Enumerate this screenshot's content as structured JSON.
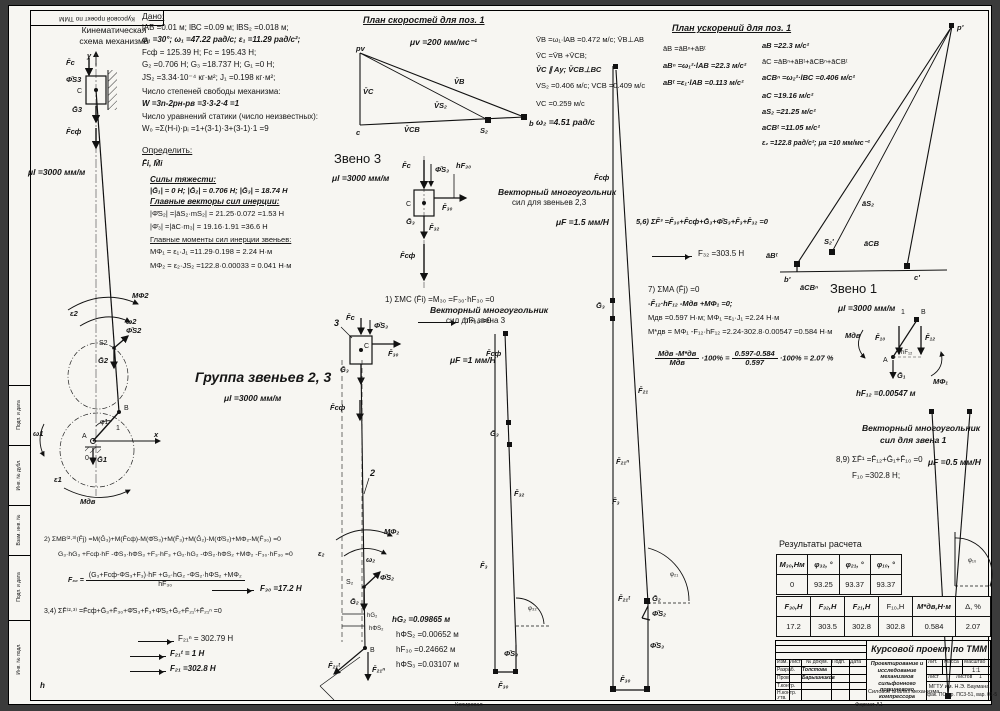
{
  "frame": {
    "top_stamp": "Курсовой проект по ТММ",
    "margin_labels": [
      "Подп. и дата",
      "Инв. № дубл.",
      "Взам. инв. №",
      "Подп. и дата",
      "Инв. № подл."
    ],
    "kopiroval": "Копировал",
    "format": "Формат А1",
    "stray_h": "h"
  },
  "kin": {
    "title1": "Кинематическая",
    "title2": "схема механизма",
    "scale": "μl =3000 мм/м",
    "labels": {
      "y": "y",
      "x": "x",
      "Fc": "F̄с",
      "PhiS3": "Φ̄S3",
      "C": "C",
      "G3": "Ḡ3",
      "Fsf": "F̄сф",
      "MPhi2": "MΦ2",
      "eps2": "ε2",
      "omega2": "ω2",
      "S2": "S2",
      "PhiS2": "Φ̄S2",
      "G2": "Ḡ2",
      "B": "B",
      "phi1": "φ1",
      "one": "1",
      "A": "A",
      "zero": "0",
      "G1": "Ḡ1",
      "omega1": "ω1",
      "eps1": "ε1",
      "Mdv": "Mдв"
    }
  },
  "given": {
    "title": "Дано:",
    "lines": [
      "lАВ =0.01 м; lВС =0.09 м; lBS₂ =0.018 м;",
      "φ₁ =30°; ω₁ =47.22 рад/с; ε₁ =11.29 рад/с²;",
      "Fсф = 125.39 Н; Fс = 195.43 Н;",
      "G₂ =0.706 Н; G₃ =18.737 Н; G₁ =0 Н;",
      "JS₂ =3.34·10⁻⁴ кг·м²; J₁ =0.198 кг·м²;",
      "Число степеней свободы механизма:",
      "W =3n-2pн-pв =3·3-2·4 =1",
      "Число уравнений статики (число неизвестных):",
      "W₀ =Σ(H-i)·pᵢ =1+(3-1)·3+(3-1)·1 =9"
    ]
  },
  "opr": {
    "title": "Определить:",
    "value": "F̄i, M̄i"
  },
  "forces": {
    "lines": [
      "Силы тяжести:",
      "|Ḡ₁| = 0 Н; |Ḡ₂| = 0.706 Н; |Ḡ₃| = 18.74 Н",
      "Главные векторы сил инерции:",
      "|Φ̄S₂| =|āS₂·mS₂| = 21.25·0.072 =1.53 Н",
      "|Φ̄₃| =|āC·m₃| = 19.16·1.91 =36.6 Н",
      "Главные моменты сил инерции звеньев:",
      "MΦ₁ = ε₁·J₁ =11.29·0.198 = 2.24 Н·м",
      "MΦ₂ = ε₂·JS₂ =122.8·0.00033 = 0.041 Н·м"
    ]
  },
  "vplan": {
    "title": "План скоростей для поз. 1",
    "scale": "μv =200 мм/мс⁻¹",
    "formulas": [
      "V̄B =ω₁·lАВ =0.472 м/с;  V̄B⊥АВ",
      "V̄C =V̄B +V̄CB;",
      "V̄C ∥ Ay;  V̄CB⊥ВС",
      "VS₂ =0.406 м/с;   VСВ =0.409 м/с",
      "VC =0.259 м/с",
      "ω₂ =4.51 рад/с"
    ],
    "labels": {
      "pv": "pv",
      "c": "c",
      "b": "b",
      "S2": "S₂",
      "VC": "V̄C",
      "VB": "V̄B",
      "VS2": "V̄S₂",
      "VCB": "V̄CB"
    }
  },
  "aplan": {
    "title": "План ускорений для поз. 1",
    "col1": [
      "āB =āBⁿ+āBᵗ",
      "aBⁿ =ω₁²·lАВ =22.3 м/с²",
      "aBᵗ =ε₁·lАВ =0.113 м/с²"
    ],
    "col2": [
      "aB =22.3 м/с²",
      "āC =āBⁿ+āBᵗ+āCBⁿ+āCBᵗ",
      "aCBⁿ =ω₂²·lВС =0.406 м/с²",
      "aC =19.16 м/с²",
      "aS₂ =21.25 м/с²",
      "aCBᵗ =11.05 м/с²",
      "ε₂ =122.8 рад/с²;  μa =10 мм/мс⁻²"
    ],
    "labels": {
      "p": "p'",
      "aS2": "āS₂",
      "aCB": "āCB",
      "aBt": "āBᵗ",
      "S2": "S₂'",
      "b": "b'",
      "aCBn": "āCBⁿ",
      "c": "c'"
    }
  },
  "zv3": {
    "title": "Звено 3",
    "scale": "μl =3000 мм/м",
    "eq": "1) ΣMC (F̄i) =M₃₀ =F₃₀·hF₃₀ =0",
    "res": "hF₃₀ =0",
    "labels": {
      "Fc": "F̄с",
      "PhiS3": "Φ̄S₃",
      "hF30": "hF₃₀",
      "F30": "F̄₃₀",
      "C": "C",
      "G3": "Ḡ₃",
      "F32": "F̄₃₂",
      "Fsf": "F̄сф"
    }
  },
  "poly23": {
    "t1": "Векторный многоугольник",
    "t2": "сил для звеньев 2,3",
    "scale": "μF =1.5 мм/Н",
    "labels": {
      "Fsf": "F̄сф",
      "G3": "Ḡ₃",
      "F21": "F̄₂₁",
      "F21n": "F̄₂₁ⁿ",
      "F3": "F̄₃",
      "F21t": "F̄₂₁ᵗ",
      "G2": "Ḡ₂",
      "PhiS2": "Φ̄S₂",
      "phi21": "φ₂₁",
      "PhiS3": "Φ̄S₃",
      "F30": "F̄₃₀"
    }
  },
  "poly3": {
    "t1": "Векторный многоугольник",
    "t2": "сил для звена 3",
    "scale": "μF =1 мм/Н",
    "labels": {
      "Fsf": "F̄сф",
      "G3": "Ḡ₃",
      "F32": "F̄₃₂",
      "F3": "F̄₃",
      "phi32": "φ₃₂",
      "PhiS3": "Φ̄S₃",
      "F30": "F̄₃₀"
    }
  },
  "gr23": {
    "title": "Группа звеньев 2, 3",
    "scale": "μl =3000 мм/м",
    "hvals": [
      "hG₂ =0.09865 м",
      "hΦS₂ =0.00652 м",
      "hF₃₀ =0.24662 м",
      "hΦS₃ =0.03107 м"
    ],
    "labels": {
      "three": "3",
      "Fc": "F̄с",
      "PhiS3": "Φ̄S₃",
      "C": "C",
      "F30": "F̄₃₀",
      "G3": "Ḡ₃",
      "Fsf": "F̄сф",
      "two": "2",
      "MPhi2": "MΦ₂",
      "eps2": "ε₂",
      "omega2": "ω₂",
      "S2": "S₂",
      "PhiS2": "Φ̄S₂",
      "G2": "Ḡ₂",
      "hG2": "hG₂",
      "hPhiS2": "hΦS₂",
      "B": "B",
      "F21t": "F̄₂₁ᵗ",
      "F21n": "F̄₂₁ⁿ"
    }
  },
  "eq2": {
    "l1": "2) ΣMB⁽²·³⁾(F̄j) =M(Ḡ₃)+M(F̄сф)-M(Φ̄S₃)+M(F̄₃)+M(Ḡ₂)-M(Φ̄S₂)+MΦ₂-M(F̄₃₀) =0",
    "l2": "G₃·hG₃ +Fсф·hF -ΦS₃·hΦS₃ +F₃·hF₃ +G₂·hG₂ -ΦS₂·hΦS₂ +MΦ₂ -F₃₀·hF₃₀ =0",
    "lhs": "F₃₀ =",
    "num": "(G₃+Fсф-ΦS₃+F₃)·hF +G₂·hG₂ -ΦS₂·hΦS₂ +MΦ₂",
    "den": "hF₃₀",
    "res": "F₃₀ =17.2 Н"
  },
  "eq34": {
    "l1": "3,4) ΣF̄⁽²·³⁾ =F̄сф+Ḡ₃+F̄₃₀+Φ̄S₃+F̄₃+Φ̄S₂+Ḡ₂+F̄₂₁ᵗ+F̄₂₁ⁿ =0",
    "r1": "F₂₁ⁿ = 302.79 Н",
    "r2": "F₂₁ᵗ = 1 Н",
    "r3": "F₂₁ =302.8 Н"
  },
  "eq56": {
    "l1": "5,6) ΣF̄³ =F̄₃₀+F̄сф+Ḡ₃+Φ̄S₃+F̄₃+F̄₃₂ =0",
    "res": "F₃₂ =303.5 Н"
  },
  "eq7": {
    "l1": "7) ΣMA (F̄j) =0",
    "l2": "-F̄₁₂·hF₁₂ -Mдв +MΦ₁ =0;",
    "l3": "Mдв =0.597 Н·м;  MΦ₁ =ε₁·J₁ =2.24 Н·м",
    "l4": "M*дв = MΦ₁ -F₁₂·hF₁₂ =2.24-302.8·0.00547 =0.584 Н·м",
    "f1n": "Mдв -M*дв",
    "f1d": "Mдв",
    "mid": "·100% =",
    "f2n": "0.597-0.584",
    "f2d": "0.597",
    "tail": "·100% = 2.07 %"
  },
  "zv1": {
    "title": "Звено 1",
    "scale": "μl =3000 мм/м",
    "hval": "hF₁₂ =0.00547 м",
    "labels": {
      "one": "1",
      "B": "B",
      "Mdv": "Mдв",
      "F10": "F̄₁₀",
      "F12": "F̄₁₂",
      "A": "A",
      "hF12": "hF₁₂",
      "G1": "Ḡ₁",
      "MPhi1": "MΦ₁"
    }
  },
  "poly1": {
    "t1": "Векторный многоугольник",
    "t2": "сил для звена 1",
    "eq": "8,9) ΣF̄¹ =F̄₁₂+Ḡ₁+F̄₁₀ =0",
    "res": "F₁₀ =302.8 Н;",
    "scale": "μF =0.5 мм/Н",
    "labels": {
      "F10": "F̄₁₀",
      "F12": "F̄₁₂",
      "phi10": "φ₁₀"
    }
  },
  "results": {
    "title": "Результаты расчета",
    "h1": [
      "M₃₀,Нм",
      "φ₃₂, °",
      "φ₂₁, °",
      "φ₁₀, °"
    ],
    "v1": [
      "0",
      "93.25",
      "93.37",
      "93.37"
    ],
    "h2": [
      "F₃₀,Н",
      "F₃₂,Н",
      "F₂₁,Н",
      "F₁₀,Н",
      "M*дв,Н·м",
      "Δ, %"
    ],
    "v2": [
      "17.2",
      "303.5",
      "302.8",
      "302.8",
      "0.584",
      "2.07"
    ]
  },
  "stamp": {
    "title": "Курсовой проект по ТММ",
    "cols": [
      "Изм.",
      "Лист",
      "№ докум.",
      "Подп.",
      "Дата"
    ],
    "r1l": "Разраб.",
    "r1v": "Толстова",
    "r2l": "Пров.",
    "r2v": "Барышников",
    "r3l": "Т.контр.",
    "r4l": "Н.контр.",
    "r5l": "Утв.",
    "d1": "Проектирование и исследование",
    "d2": "механизмов сильфонного",
    "d3": "поршневого компрессора",
    "d4": "Силовой анализ механизма",
    "lit": "Лит.",
    "massa": "Масса",
    "masshtab": "Масштаб",
    "mval": "1:1",
    "list": "Лист",
    "listov": "Листов",
    "listov_val": "1",
    "org": "МГТУ им. Н.Э. Баумана",
    "org2": "фак. ПС, гр. ПС3-51, вар. 01-5"
  }
}
